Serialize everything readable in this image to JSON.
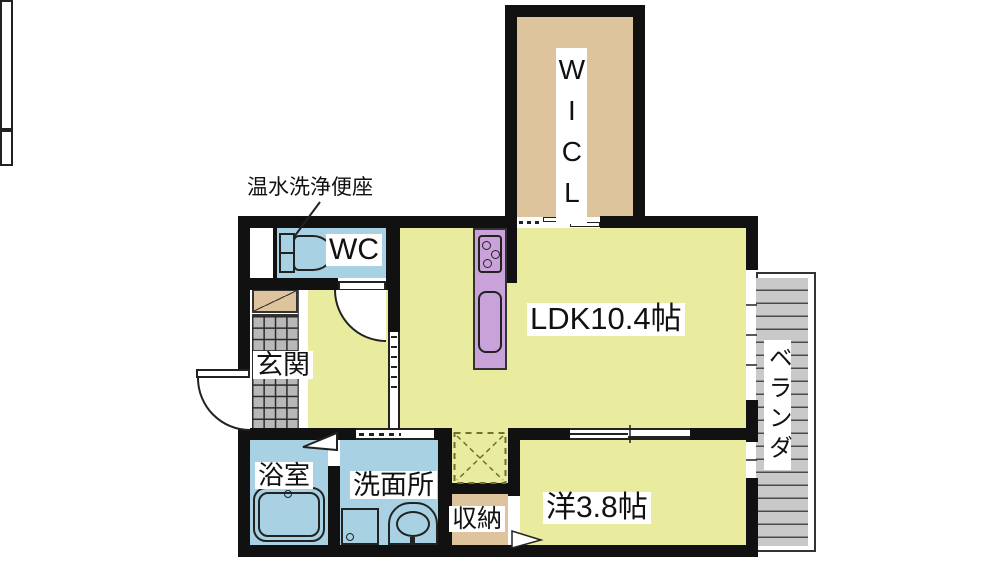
{
  "plan": {
    "title": "apartment-floor-plan",
    "labels": {
      "wicl": "WICL",
      "ldk": "LDK10.4帖",
      "western_room": "洋3.8帖",
      "genkan": "玄関",
      "bath": "浴室",
      "washroom": "洗面所",
      "storage": "収納",
      "wc": "WC",
      "veranda": "ベランダ"
    },
    "annotations": {
      "toilet_note": "温水洗浄便座"
    },
    "colors": {
      "room_yellow": "#e9ec9e",
      "room_tan": "#dec49c",
      "room_blue": "#a8d2e4",
      "kitchen_purple": "#c8a2d8",
      "veranda_gray": "#c9c9c9",
      "wall_black": "#111111"
    }
  }
}
